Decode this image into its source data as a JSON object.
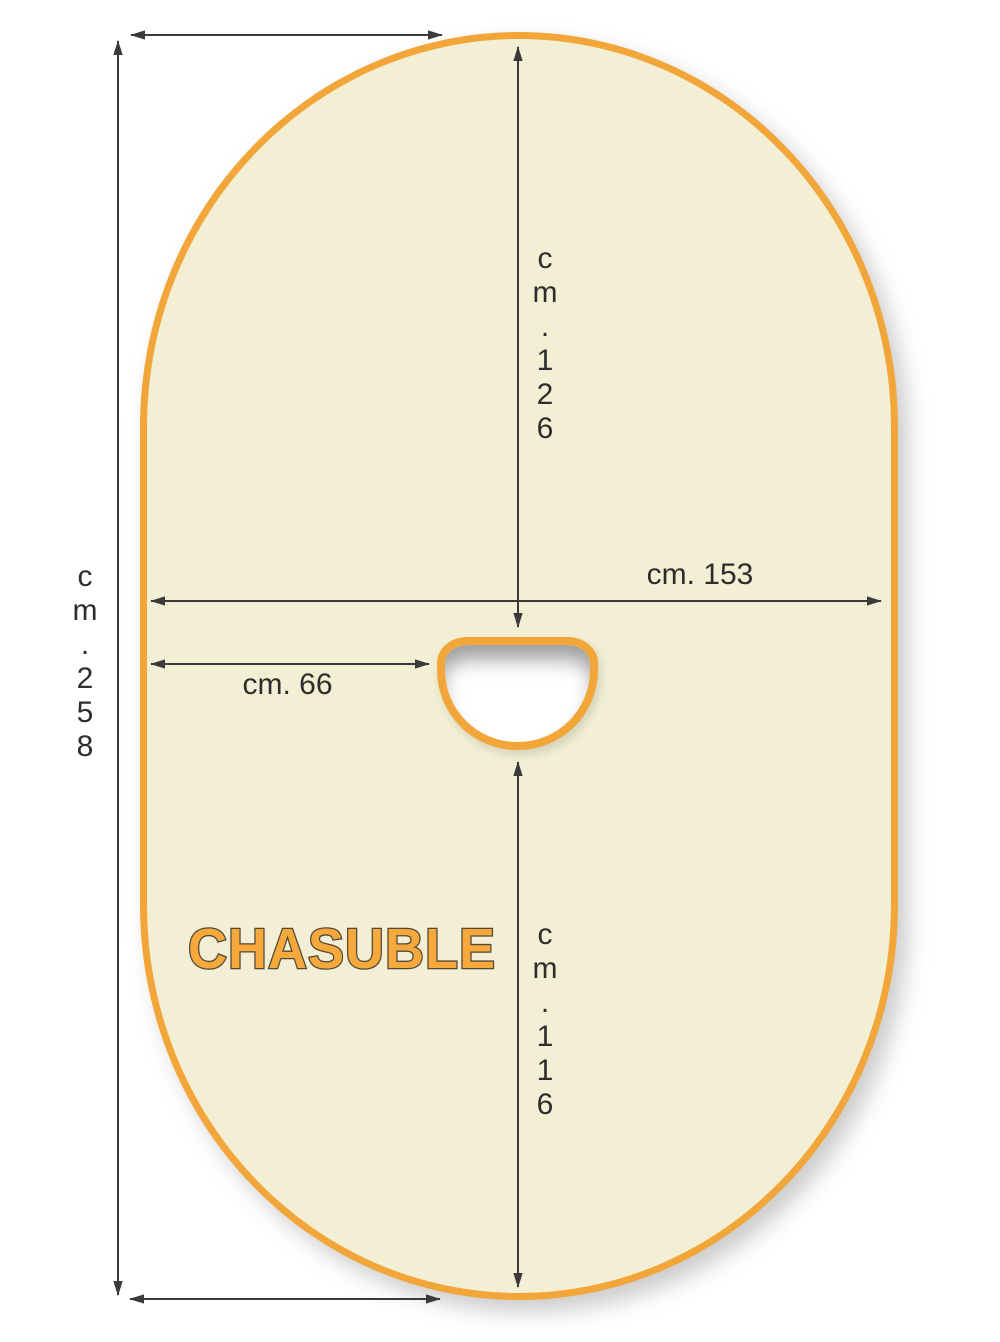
{
  "diagram": {
    "garment_label": "CHASUBLE",
    "labels": {
      "total_height_stacked": "c\nm\n.\n2\n5\n8",
      "upper_height_stacked": "c\nm\n.\n1\n2\n6",
      "width": "cm. 153",
      "neck_offset": "cm. 66",
      "lower_height_stacked": "c\nm\n.\n1\n1\n6"
    },
    "values": {
      "total_height": "cm. 258",
      "upper_height": "cm. 126",
      "width": "cm. 153",
      "neck_offset": "cm. 66",
      "lower_height": "cm. 116"
    },
    "colors": {
      "fabric_fill": "#F2EFD4",
      "outline_orange": "#F2A63A",
      "dimension_line": "#3A3A3A",
      "label_text": "#2D2D2D",
      "title_fill": "#F6A83B",
      "title_outline": "#51483A",
      "background": "#FFFFFF"
    }
  }
}
